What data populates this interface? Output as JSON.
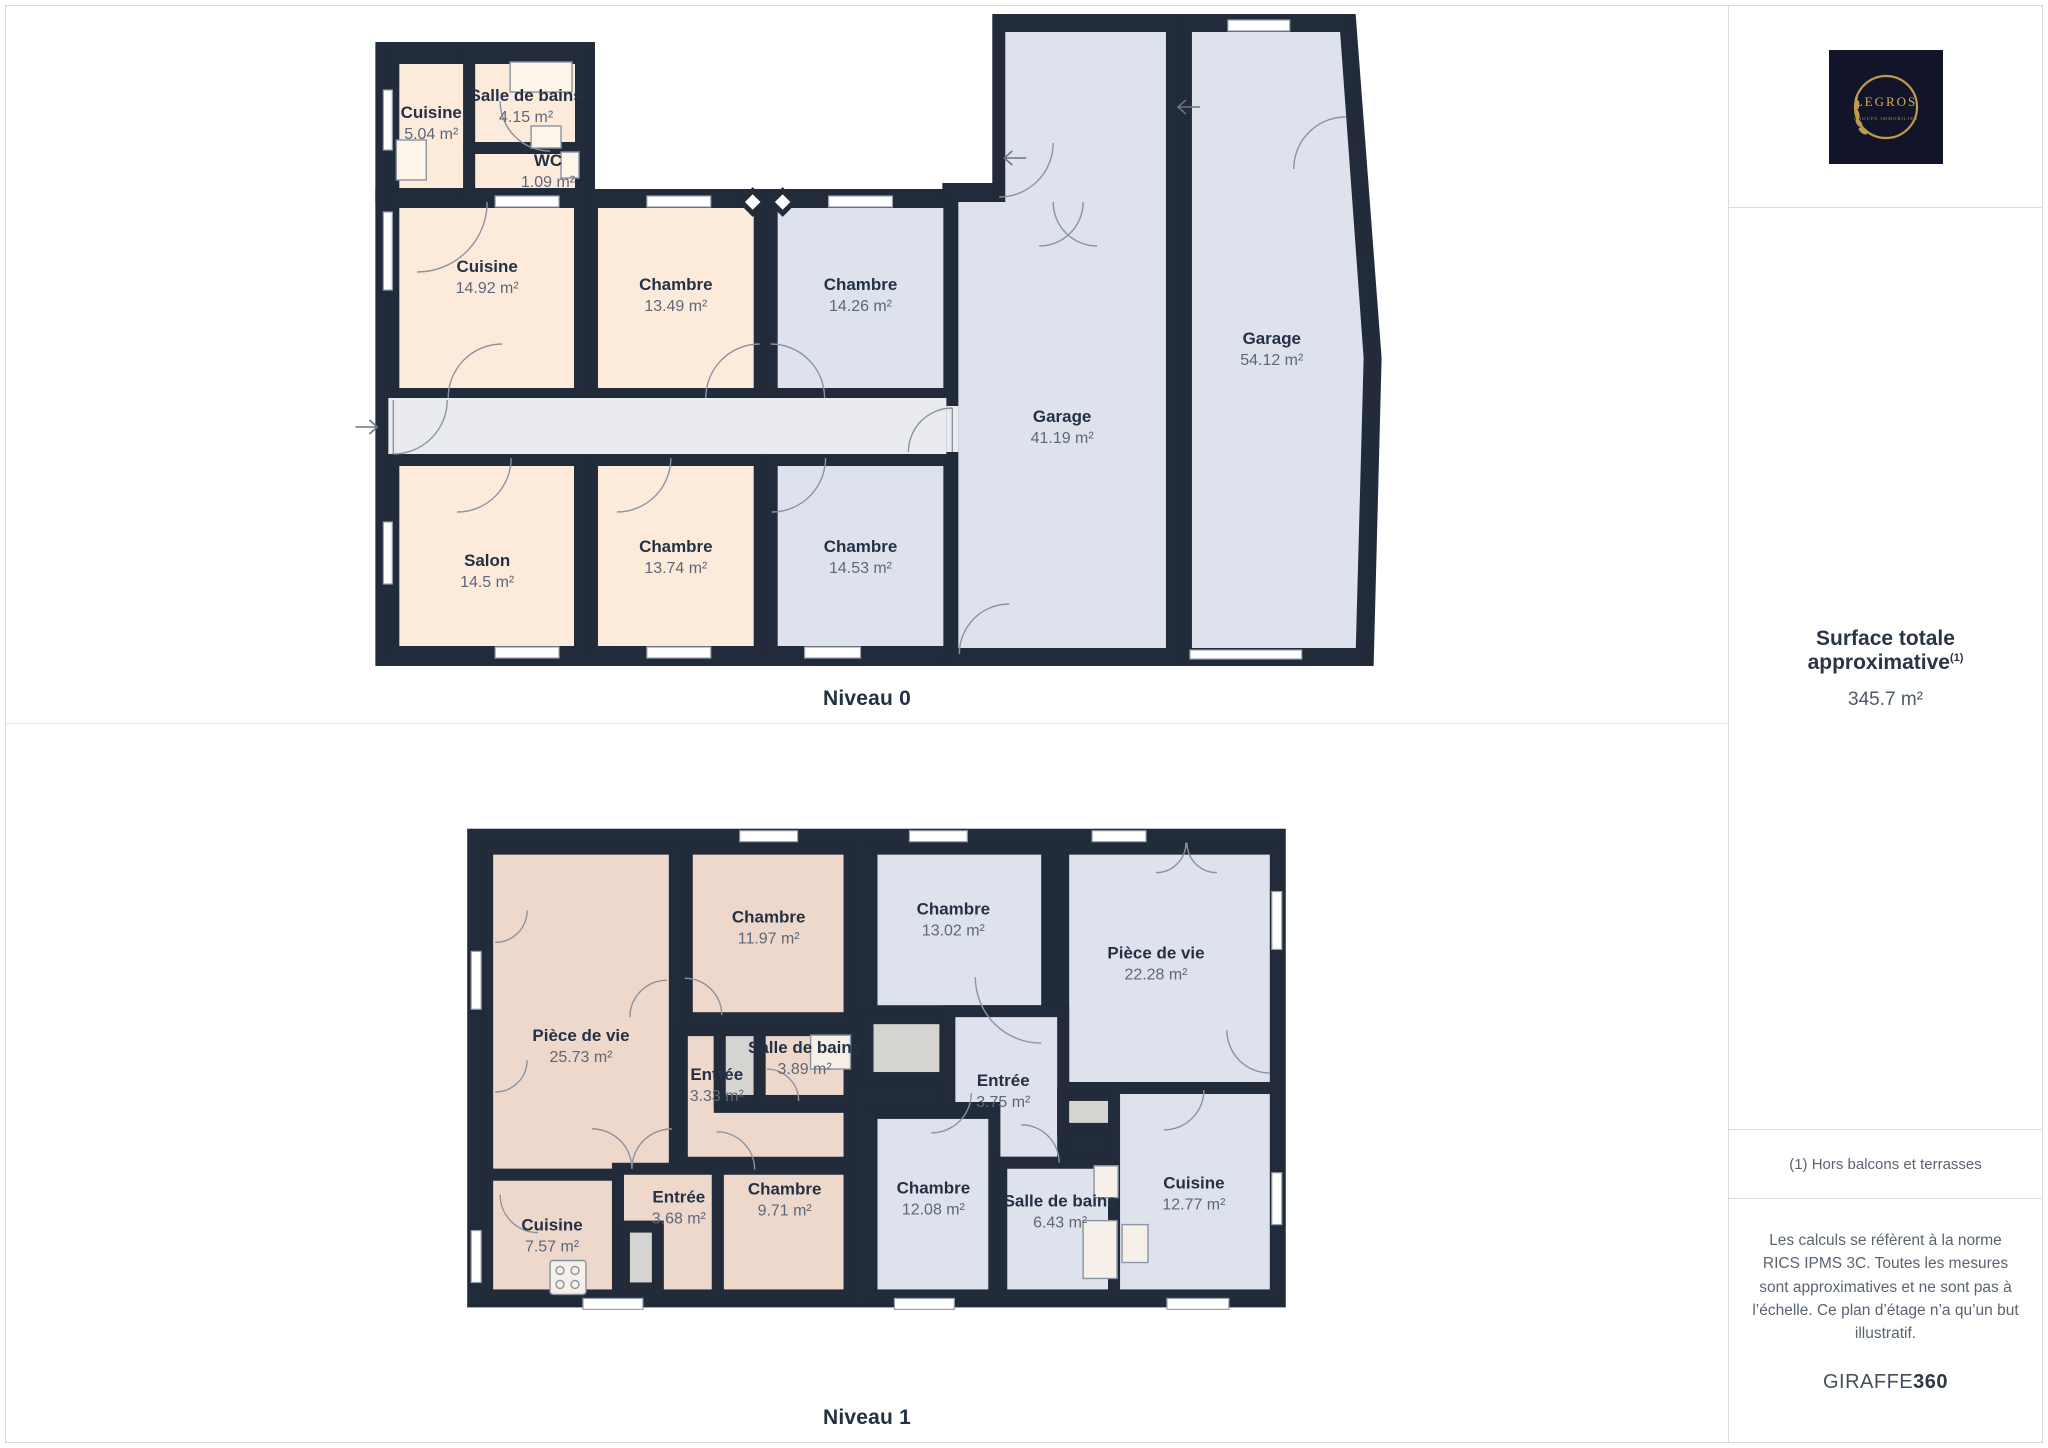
{
  "colors": {
    "wall": "#212b39",
    "peach": "#fcebdb",
    "blue": "#dde2ed",
    "pink": "#eed8cb",
    "hall": "#e9ebee",
    "closet": "#d6d4d0"
  },
  "floors": [
    {
      "label": "Niveau 0",
      "shells": [
        {
          "rect": [
            370,
            36,
            220,
            160
          ]
        },
        {
          "rect": [
            370,
            183,
            590,
            477
          ]
        },
        {
          "poly": "988,8 1352,8 1378,352 1370,660 938,660 938,177 988,177"
        }
      ],
      "rooms": [
        {
          "name": "Cuisine",
          "area": "5.04 m²",
          "rect": [
            388,
            52,
            76,
            136
          ],
          "fill": "peach",
          "label": [
            426,
            112
          ]
        },
        {
          "name": "Salle de bains",
          "area": "4.15 m²",
          "rect": [
            464,
            52,
            112,
            90
          ],
          "fill": "peach",
          "label": [
            521,
            95
          ]
        },
        {
          "name": "WC",
          "area": "1.09 m²",
          "rect": [
            464,
            142,
            112,
            46
          ],
          "fill": "peach",
          "label": [
            543,
            160
          ]
        },
        {
          "name": "Cuisine",
          "area": "14.92 m²",
          "rect": [
            388,
            196,
            187,
            192
          ],
          "fill": "peach",
          "label": [
            482,
            266
          ]
        },
        {
          "name": "Chambre",
          "area": "13.49 m²",
          "rect": [
            587,
            196,
            168,
            192
          ],
          "fill": "peach",
          "label": [
            671,
            284
          ]
        },
        {
          "name": "Chambre",
          "area": "14.26 m²",
          "rect": [
            767,
            196,
            178,
            192
          ],
          "fill": "blue",
          "label": [
            856,
            284
          ]
        },
        {
          "rect": [
            383,
            392,
            565,
            58
          ],
          "fill": "hall",
          "stroke": false
        },
        {
          "name": "Salon",
          "area": "14.5 m²",
          "rect": [
            388,
            454,
            187,
            192
          ],
          "fill": "peach",
          "label": [
            482,
            560
          ]
        },
        {
          "name": "Chambre",
          "area": "13.74 m²",
          "rect": [
            587,
            454,
            168,
            192
          ],
          "fill": "peach",
          "label": [
            671,
            546
          ]
        },
        {
          "name": "Chambre",
          "area": "14.53 m²",
          "rect": [
            767,
            454,
            178,
            192
          ],
          "fill": "blue",
          "label": [
            856,
            546
          ]
        },
        {
          "name": "Garage",
          "area": "41.19 m²",
          "poly": "995,20 1168,20 1168,648 948,648 948,190 995,190",
          "fill": "blue",
          "label": [
            1058,
            416
          ]
        },
        {
          "name": "Garage",
          "area": "54.12 m²",
          "poly": "1182,20 1342,20 1366,352 1358,648 1182,648",
          "fill": "blue",
          "label": [
            1268,
            338
          ]
        }
      ]
    },
    {
      "label": "Niveau 1",
      "shells": [
        {
          "rect": [
            462,
            105,
            820,
            480
          ]
        }
      ],
      "rooms": [
        {
          "name": "Pièce de vie",
          "area": "25.73 m²",
          "rect": [
            482,
            125,
            188,
            327
          ],
          "fill": "pink",
          "label": [
            576,
            318
          ]
        },
        {
          "name": "Chambre",
          "area": "11.97 m²",
          "rect": [
            682,
            125,
            163,
            170
          ],
          "fill": "pink",
          "label": [
            764,
            199
          ]
        },
        {
          "name": "Entrée",
          "area": "3.33 m²",
          "poly": "677,307 715,307 715,384 845,384 845,440 677,440",
          "fill": "pink",
          "label": [
            712,
            357
          ]
        },
        {
          "rect": [
            715,
            307,
            40,
            71
          ],
          "fill": "closet"
        },
        {
          "name": "Salle de bains",
          "area": "3.89 m²",
          "rect": [
            755,
            307,
            90,
            71
          ],
          "fill": "pink",
          "label": [
            800,
            330
          ]
        },
        {
          "name": "Chambre",
          "area": "9.71 m²",
          "rect": [
            713,
            446,
            132,
            127
          ],
          "fill": "pink",
          "label": [
            780,
            472
          ]
        },
        {
          "name": "Entrée",
          "area": "3.68 m²",
          "rect": [
            613,
            446,
            100,
            127
          ],
          "fill": "pink",
          "label": [
            674,
            480
          ]
        },
        {
          "rect": [
            619,
            504,
            34,
            62
          ],
          "fill": "closet"
        },
        {
          "name": "Cuisine",
          "area": "7.57 m²",
          "rect": [
            482,
            452,
            131,
            121
          ],
          "fill": "pink",
          "label": [
            547,
            508
          ]
        },
        {
          "name": "Chambre",
          "area": "13.02 m²",
          "rect": [
            867,
            125,
            176,
            163
          ],
          "fill": "blue",
          "label": [
            949,
            191
          ]
        },
        {
          "name": "Pièce de vie",
          "area": "22.28 m²",
          "rect": [
            1059,
            125,
            213,
            240
          ],
          "fill": "blue",
          "label": [
            1152,
            235
          ]
        },
        {
          "rect": [
            863,
            295,
            78,
            60
          ],
          "fill": "closet"
        },
        {
          "name": "Entrée",
          "area": "3.75 m²",
          "poly": "945,288 1059,288 1059,440 990,440 990,385 945,385",
          "fill": "blue",
          "label": [
            999,
            363
          ]
        },
        {
          "rect": [
            1059,
            372,
            51,
            34
          ],
          "fill": "closet"
        },
        {
          "name": "Chambre",
          "area": "12.08 m²",
          "rect": [
            867,
            390,
            123,
            183
          ],
          "fill": "blue",
          "label": [
            929,
            471
          ]
        },
        {
          "name": "Salle de bains",
          "area": "6.43 m²",
          "rect": [
            997,
            440,
            113,
            133
          ],
          "fill": "blue",
          "label": [
            1056,
            484
          ]
        },
        {
          "name": "Cuisine",
          "area": "12.77 m²",
          "rect": [
            1110,
            365,
            162,
            208
          ],
          "fill": "blue",
          "label": [
            1190,
            466
          ]
        }
      ]
    }
  ],
  "sidebar": {
    "logo": {
      "brand": "LEGROS",
      "tagline": "GROUPE IMMOBILIER"
    },
    "surface": {
      "title": "Surface totale approximative",
      "superscript": "(1)",
      "value": "345.7 m²"
    },
    "footnote": "(1) Hors balcons et terrasses",
    "disclaimer": "Les calculs se réfèrent à la norme RICS IPMS 3C. Toutes les mesures sont approximatives et ne sont pas à l’échelle. Ce plan d’étage n’a qu’un but illustratif.",
    "brand_footer": {
      "name": "GIRAFFE",
      "suffix": "360"
    }
  }
}
